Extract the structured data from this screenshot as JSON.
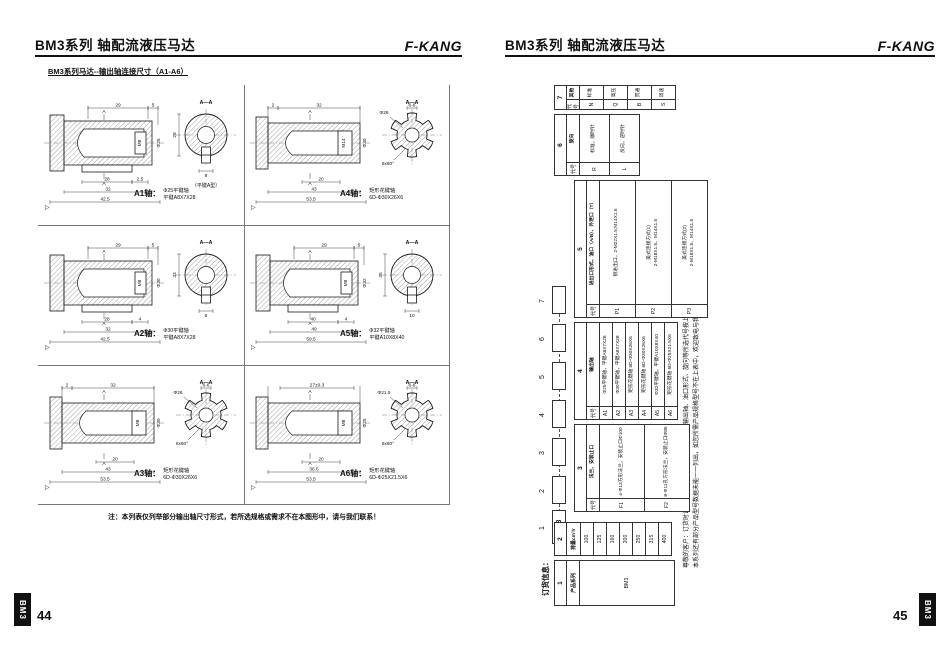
{
  "pages": {
    "left": {
      "header": {
        "title": "BM3系列 轴配流液压马达",
        "brand": "F-KANG"
      },
      "subtitle": "BM3系列马达--输出轴连接尺寸（A1-A6）",
      "note": "注：本列表仅列举部分输出轴尺寸形式，若所选规格或需求不在本图形中，请与我们联系！",
      "page_number": "44",
      "spine": "BM3",
      "shafts": [
        {
          "id": "A1",
          "label": "A1轴：",
          "type": "key",
          "caption": [
            "Φ25平键轴",
            "平键A8X7X28"
          ],
          "top_dims": [
            "29",
            "5"
          ],
          "bottom_dims": [
            [
              "28",
              "2.5"
            ],
            [
              "32"
            ],
            [
              "42.5"
            ]
          ],
          "dia": "Φ25",
          "thread": "M8",
          "section": {
            "label": "A—A",
            "dim1": "28",
            "dim2": "8",
            "note": "（平键A型）"
          }
        },
        {
          "id": "A4",
          "label": "A4轴：",
          "type": "spline",
          "caption": [
            "矩形花键轴",
            "6D-Φ30X26X6"
          ],
          "top_dims": [
            "2",
            "32"
          ],
          "bottom_dims": [
            [
              "20"
            ],
            [
              "43"
            ],
            [
              "53.5"
            ]
          ],
          "dia": "Φ30",
          "thread": "M14",
          "section": {
            "label": "A—A",
            "teeth": "6-6",
            "dia": "Φ26",
            "angle": "6x60°"
          }
        },
        {
          "id": "A2",
          "label": "A2轴：",
          "type": "key",
          "caption": [
            "Φ30平键轴",
            "平键A8X7X28"
          ],
          "top_dims": [
            "29",
            "5"
          ],
          "bottom_dims": [
            [
              "28",
              "4"
            ],
            [
              "32"
            ],
            [
              "42.5"
            ]
          ],
          "dia": "Φ30",
          "thread": "M8",
          "section": {
            "label": "A—A",
            "dim1": "33",
            "dim2": "8",
            "note": ""
          }
        },
        {
          "id": "A5",
          "label": "A5轴：",
          "type": "key",
          "caption": [
            "Φ32平键轴",
            "平键A10X8X40"
          ],
          "top_dims": [
            "29",
            "5"
          ],
          "bottom_dims": [
            [
              "40",
              "4"
            ],
            [
              "49"
            ],
            [
              "59.5"
            ]
          ],
          "dia": "Φ32",
          "thread": "M8",
          "section": {
            "label": "A—A",
            "dim1": "35",
            "dim2": "10",
            "note": ""
          }
        },
        {
          "id": "A3",
          "label": "A3轴：",
          "type": "spline",
          "caption": [
            "矩形花键轴",
            "6D-Φ30X26X6"
          ],
          "top_dims": [
            "2",
            "32"
          ],
          "bottom_dims": [
            [
              "20"
            ],
            [
              "43"
            ],
            [
              "53.5"
            ]
          ],
          "dia": "Φ30",
          "thread": "M8",
          "section": {
            "label": "A—A",
            "teeth": "6-6",
            "dia": "Φ26",
            "angle": "6x60°"
          }
        },
        {
          "id": "A6",
          "label": "A6轴：",
          "type": "spline",
          "caption": [
            "矩形花键轴",
            "6D-Φ25X21.5X6"
          ],
          "top_dims": [
            "27±0.3"
          ],
          "bottom_dims": [
            [
              "20"
            ],
            [
              "36.6"
            ],
            [
              "53.5"
            ]
          ],
          "dia": "Φ25",
          "thread": "M8",
          "section": {
            "label": "A—A",
            "teeth": "6-6",
            "dia": "Φ21.5",
            "angle": "6x60°"
          }
        }
      ]
    },
    "right": {
      "header": {
        "title": "BM3系列 轴配流液压马达",
        "brand": "F-KANG"
      },
      "page_number": "45",
      "spine": "BM3",
      "ordering": {
        "title": "订货信息：",
        "diagram": {
          "first_box": "BM3",
          "numbers": [
            "1",
            "2",
            "3",
            "4",
            "5",
            "6",
            "7"
          ]
        },
        "tables": [
          {
            "num": "1",
            "type": "plain",
            "header": "产品系列",
            "values": [
              "BM3"
            ]
          },
          {
            "num": "2",
            "type": "plain",
            "header": "排量cm³/r",
            "values": [
              "100",
              "125",
              "160",
              "200",
              "250",
              "315",
              "400"
            ]
          },
          {
            "num": "3",
            "type": "coded",
            "code_header": "代号",
            "label": "法兰、安装止口",
            "rows": [
              {
                "code": "F1",
                "text": "4-Φ13方形法兰，安装止口Φ100"
              },
              {
                "code": "F2",
                "text": "8-Φ11孔方形法兰，安装止口Φ85"
              }
            ]
          },
          {
            "num": "4",
            "type": "coded",
            "code_header": "代号",
            "label": "输出轴",
            "rows": [
              {
                "code": "A1",
                "text": "Φ25平键轴，平键A8X7X28"
              },
              {
                "code": "A2",
                "text": "Φ30平键轴，平键A8X7X28"
              },
              {
                "code": "A3",
                "text": "矩形花键轴 6D-Φ30X26X6"
              },
              {
                "code": "A4",
                "text": "矩形花键轴 6D-Φ30X26X6"
              },
              {
                "code": "A5",
                "text": "Φ32平键轴，平键A10X8X40"
              },
              {
                "code": "A6",
                "text": "矩形花键轴 6D-Φ25X21.5X6"
              }
            ]
          },
          {
            "num": "5",
            "type": "coded",
            "code_header": "代号",
            "label": "进出口形式、油口（A/B）、外泄口（T）",
            "rows": [
              {
                "code": "P1",
                "text": "侧进出口，2-M22X1.5;M14X1.5"
              },
              {
                "code": "P2",
                "text": "美式连接方式(1)",
                "text2": "2-M18X1.5、M14X1.5"
              },
              {
                "code": "P3",
                "text": "美式连接方式(2)",
                "text2": "2-M18X1.5、M14X1.5"
              }
            ]
          },
          {
            "num": "6",
            "type": "coded",
            "code_header": "代号",
            "label": "旋向",
            "rows": [
              {
                "code": "R",
                "text": "标准，顺时针"
              },
              {
                "code": "L",
                "text": "反向，逆时针"
              }
            ]
          },
          {
            "num": "7",
            "type": "coded",
            "code_header": "代号",
            "label": "其他",
            "rows": [
              {
                "code": "N",
                "text": "标准"
              },
              {
                "code": "Q",
                "text": "高压"
              },
              {
                "code": "B",
                "text": "贯通"
              },
              {
                "code": "S",
                "text": "调速"
              }
            ]
          }
        ],
        "notes": [
          "尊敬的客户：订货时请将产品系列、排量、法兰止口、输出轴、油口形式、旋向等所选代号按上表填写信息即可。",
          "本系列还有部分产品型号数据未能一一列出，如您所需产品规格型号不在上表中，欢迎致电与我们联系。"
        ]
      }
    }
  }
}
